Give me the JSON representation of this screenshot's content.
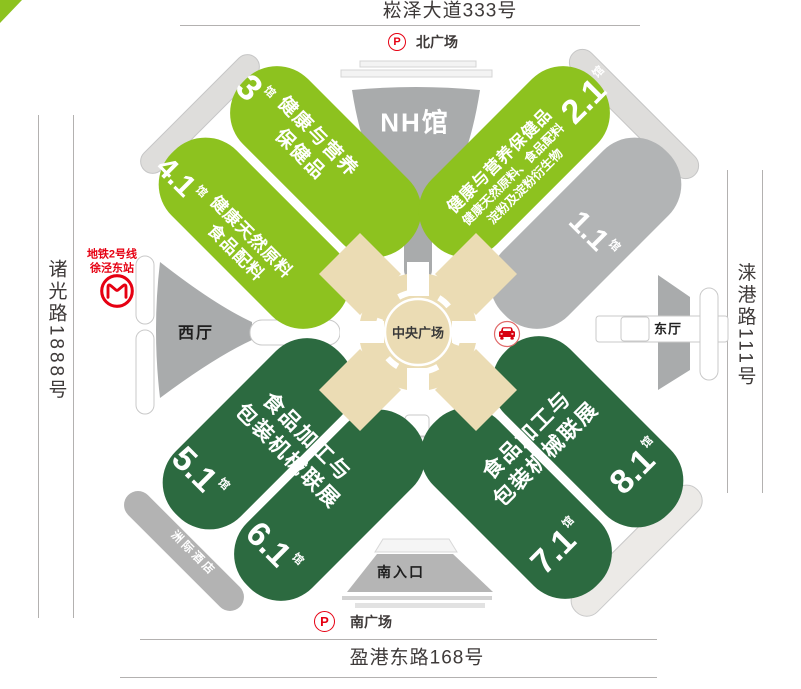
{
  "roads": {
    "north": "崧泽大道333号",
    "south": "盈港东路168号",
    "west": "诸光路1888号",
    "east": "涞港路111号"
  },
  "plazas": {
    "north": {
      "p": "P",
      "label": "北广场"
    },
    "south": {
      "p": "P",
      "label": "南广场"
    }
  },
  "center_plaza": {
    "label": "中央广场",
    "icons": [
      "car-dropoff-icon"
    ]
  },
  "buildings": {
    "nh_hall": "NH馆",
    "west_hall": "西厅",
    "east_hall": "东厅",
    "south_entrance": "南入口",
    "hotel": "洲际酒店"
  },
  "metro": {
    "line": "地铁2号线",
    "station": "徐泾东站",
    "icon": "shanghai-metro-icon"
  },
  "halls": {
    "h3": {
      "num": "3",
      "unit": "馆",
      "line1": "健康与营养",
      "line2": "保健品"
    },
    "h41": {
      "num": "4.1",
      "unit": "馆",
      "line1": "健康天然原料",
      "line2": "食品配料"
    },
    "h21": {
      "num": "2.1",
      "unit": "馆",
      "line1": "健康与营养保健品",
      "line2": "健康天然原料、食品配料",
      "line3": "淀粉及淀粉衍生物"
    },
    "h11": {
      "num": "1.1",
      "unit": "馆"
    },
    "h51": {
      "num": "5.1",
      "unit": "馆"
    },
    "h61": {
      "num": "6.1",
      "unit": "馆"
    },
    "h71": {
      "num": "7.1",
      "unit": "馆"
    },
    "h81": {
      "num": "8.1",
      "unit": "馆"
    }
  },
  "zones": {
    "southwest": {
      "line1": "食品加工与",
      "line2": "包装机械联展"
    },
    "southeast": {
      "line1": "食品加工与",
      "line2": "包装机械联展"
    }
  },
  "colors": {
    "light_green": "#8dc21f",
    "dark_green": "#2c6a40",
    "hall_gray": "#b2b4b5",
    "tan": "#ebdcb4",
    "metro_red": "#e60012",
    "parking_red": "#e60012"
  }
}
